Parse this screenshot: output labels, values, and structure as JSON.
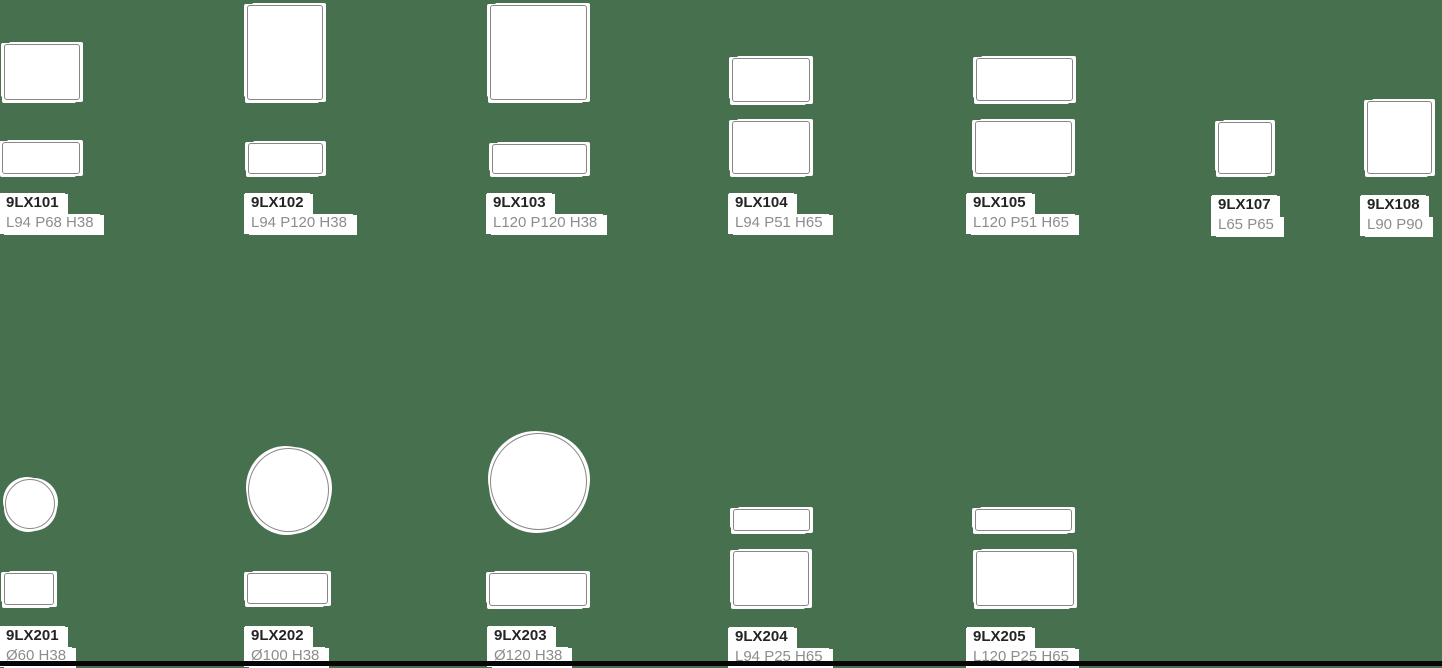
{
  "page": {
    "background_color": "#47704e",
    "bottom_bar_color": "#060606",
    "shape_fill": "#ffffff",
    "shape_border_color": "#878787",
    "code_text_color": "#242424",
    "dims_text_color": "#8d8d8d",
    "halo_color": "#ffffff"
  },
  "products": [
    {
      "code": "9LX101",
      "dims": "L94 P68 H38",
      "top_view": "rectangle",
      "front_view": "rectangle"
    },
    {
      "code": "9LX102",
      "dims": "L94 P120 H38",
      "top_view": "rectangle",
      "front_view": "rectangle"
    },
    {
      "code": "9LX103",
      "dims": "L120 P120 H38",
      "top_view": "square",
      "front_view": "rectangle"
    },
    {
      "code": "9LX104",
      "dims": "L94 P51 H65",
      "top_view": "rectangle",
      "front_view": "rectangle"
    },
    {
      "code": "9LX105",
      "dims": "L120 P51 H65",
      "top_view": "rectangle",
      "front_view": "rectangle"
    },
    {
      "code": "9LX107",
      "dims": "L65 P65",
      "top_view": "square",
      "front_view": "none"
    },
    {
      "code": "9LX108",
      "dims": "L90 P90",
      "top_view": "square",
      "front_view": "none"
    },
    {
      "code": "9LX201",
      "dims": "Ø60 H38",
      "top_view": "circle",
      "front_view": "rectangle"
    },
    {
      "code": "9LX202",
      "dims": "Ø100 H38",
      "top_view": "circle",
      "front_view": "rectangle"
    },
    {
      "code": "9LX203",
      "dims": "Ø120 H38",
      "top_view": "circle",
      "front_view": "rectangle"
    },
    {
      "code": "9LX204",
      "dims": "L94 P25 H65",
      "top_view": "rectangle",
      "front_view": "rectangle"
    },
    {
      "code": "9LX205",
      "dims": "L120 P25 H65",
      "top_view": "rectangle",
      "front_view": "rectangle"
    }
  ]
}
